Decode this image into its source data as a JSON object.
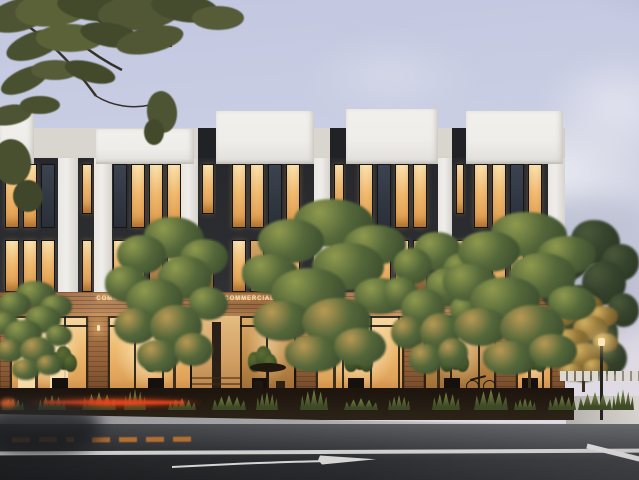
{
  "meta": {
    "alt_text": "Dusk architectural rendering of a modern three-story mixed-use building with dark window bays, white parapets, warm lit commercial storefronts, street trees, and an empty street with lane markings in the foreground"
  },
  "palette": {
    "sky_top": "#c2c7e0",
    "sky_mid": "#cdd1e5",
    "sky_bottom": "#ded9e3",
    "cloud_light": "#e8e9f1",
    "white_wall": "#efedea",
    "white_wall_recessed": "#d9d5cf",
    "white_wall_shadow": "#c8c5bf",
    "dark_bay": "#26282c",
    "dark_slot": "#202226",
    "window_lit_top": "#fbe3ae",
    "window_lit_mid": "#f2bc72",
    "window_lit_deep": "#dd9a4a",
    "window_dim": "#b98b52",
    "window_unlit_top": "#3c4350",
    "window_unlit_bottom": "#2a2f38",
    "window_frame": "#141518",
    "wood_light": "#b5835a",
    "wood_dark": "#8a5c38",
    "pier_light": "#b07a4a",
    "pier_dark": "#6e4628",
    "glass_top": "#f7d9a4",
    "glass_mid": "#edb96e",
    "glass_deep": "#c08445",
    "sign_text": "#f7dcab",
    "tree_highlight": "#8f9a4e",
    "tree_green": "#55683a",
    "tree_dark": "#33452b",
    "bg_tree": "#35422c",
    "bg_tree_dark": "#27331f",
    "gold_hi": "#d3b060",
    "gold_mid": "#96793a",
    "gold_dark": "#5f4d22",
    "shrub_light": "#7d8748",
    "shrub_dark": "#3e4a26",
    "soil": "#241b12",
    "sidewalk_left": "#97969a",
    "sidewalk_right": "#dbd9d5",
    "plaza": "#c2bfba",
    "asphalt_top": "#57595d",
    "asphalt_mid": "#3d3f43",
    "asphalt_bottom": "#26282b",
    "road_line": "#dddcda",
    "orange_marking": "#c9782f",
    "taillight": "#ff5322",
    "lamp_glow": "#ffe8b8",
    "trunk": "#3a2c1c",
    "silhouette": "#20180f"
  },
  "signs": {
    "labels": [
      "COMMERCIAL",
      "COMMERCIAL #1",
      "COMMERCIAL #2",
      "COMMERCIAL #3",
      "COMMERCIAL #4"
    ]
  },
  "facade": {
    "building_right_edge": 565,
    "parapets": [
      {
        "x": 0,
        "w": 34,
        "y": 114,
        "h": 50
      },
      {
        "x": 96,
        "w": 98,
        "y": 129,
        "h": 35
      },
      {
        "x": 216,
        "w": 98,
        "y": 111,
        "h": 53
      },
      {
        "x": 346,
        "w": 92,
        "y": 109,
        "h": 55
      },
      {
        "x": 466,
        "w": 97,
        "y": 111,
        "h": 53
      }
    ],
    "top_slots": [
      {
        "x": 198,
        "w": 18
      },
      {
        "x": 330,
        "w": 16
      },
      {
        "x": 452,
        "w": 14
      }
    ],
    "pilasters": [
      {
        "x": 58,
        "w": 20
      },
      {
        "x": 94,
        "w": 18
      },
      {
        "x": 180,
        "w": 18
      },
      {
        "x": 314,
        "w": 16
      },
      {
        "x": 438,
        "w": 14
      },
      {
        "x": 548,
        "w": 17
      }
    ],
    "bays": [
      {
        "x": 0,
        "w": 58,
        "rowA": "LLU",
        "rowB": "LLL"
      },
      {
        "x": 78,
        "w": 16,
        "rowA": "L",
        "rowB": "L"
      },
      {
        "x": 112,
        "w": 68,
        "rowA": "ULLL",
        "rowB": "LLDL"
      },
      {
        "x": 198,
        "w": 18,
        "rowA": "L",
        "rowB": "D"
      },
      {
        "x": 216,
        "w": 98,
        "rowA": "LLUL",
        "rowB": "LDLL"
      },
      {
        "x": 330,
        "w": 16,
        "rowA": "L",
        "rowB": "L"
      },
      {
        "x": 346,
        "w": 92,
        "rowA": "LULL",
        "rowB": "LLLD"
      },
      {
        "x": 452,
        "w": 14,
        "rowA": "L",
        "rowB": "L"
      },
      {
        "x": 466,
        "w": 82,
        "rowA": "LLUL",
        "rowB": "DLLL"
      }
    ]
  },
  "storefront": {
    "piers": [
      {
        "x": 0,
        "w": 10
      },
      {
        "x": 88,
        "w": 20
      },
      {
        "x": 296,
        "w": 20
      },
      {
        "x": 404,
        "w": 20
      },
      {
        "x": 496,
        "w": 20
      },
      {
        "x": 552,
        "w": 13
      }
    ],
    "entry": {
      "x": 192,
      "w": 48
    },
    "panels": [
      {
        "x": 10,
        "w": 78,
        "tone": "bright",
        "arches": true
      },
      {
        "x": 108,
        "w": 84,
        "tone": "bright"
      },
      {
        "x": 240,
        "w": 56,
        "tone": "medium"
      },
      {
        "x": 316,
        "w": 88,
        "tone": "bright"
      },
      {
        "x": 424,
        "w": 72,
        "tone": "medium"
      },
      {
        "x": 516,
        "w": 36,
        "tone": "bright"
      }
    ],
    "lamps": [
      97,
      305,
      413,
      505
    ],
    "plants": [
      52,
      148,
      252,
      348,
      444,
      522
    ]
  },
  "trees": {
    "street": [
      {
        "x": 0,
        "y": 288,
        "w": 72,
        "h": 104,
        "tone": "green"
      },
      {
        "x": 120,
        "y": 228,
        "w": 108,
        "h": 164,
        "tone": "green"
      },
      {
        "x": 262,
        "y": 212,
        "w": 144,
        "h": 182,
        "tone": "green"
      },
      {
        "x": 396,
        "y": 242,
        "w": 84,
        "h": 150,
        "tone": "green"
      },
      {
        "x": 462,
        "y": 224,
        "w": 134,
        "h": 172,
        "tone": "green"
      }
    ],
    "background": [
      {
        "x": 552,
        "y": 232,
        "w": 87,
        "h": 170,
        "tone": "dark"
      }
    ],
    "golden": [
      {
        "x": 548,
        "y": 300,
        "w": 70,
        "h": 92,
        "tone": "gold"
      }
    ]
  },
  "landscaping": {
    "grass_x": [
      2,
      38,
      82,
      124,
      168,
      212,
      256,
      300,
      344,
      388,
      432,
      474,
      514,
      548,
      578,
      612
    ]
  },
  "street": {
    "orange_dashes": [
      {
        "x": 12,
        "w": 62
      },
      {
        "x": 92,
        "w": 100
      }
    ]
  }
}
